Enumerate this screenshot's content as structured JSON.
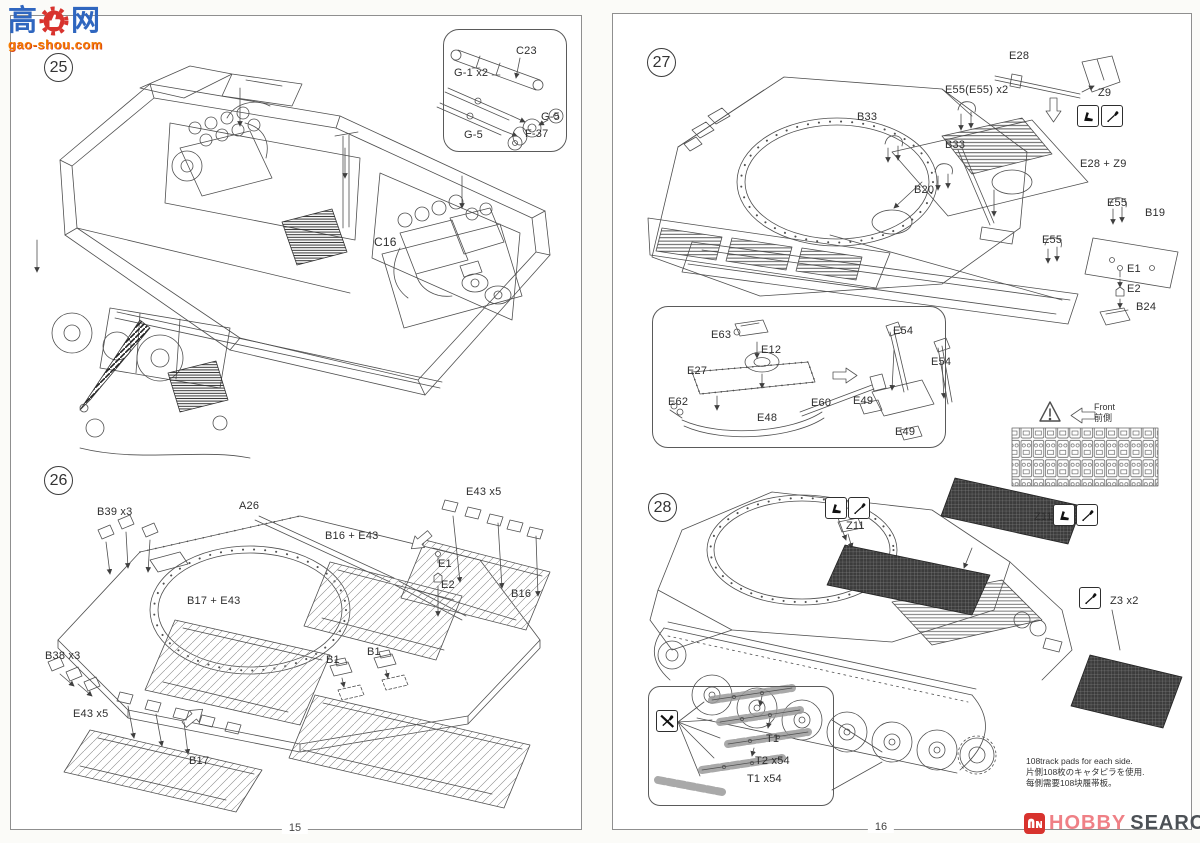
{
  "watermark": {
    "logo": "高达网",
    "url": "gao-shou.com"
  },
  "pages": {
    "left": "15",
    "right": "16"
  },
  "brand": {
    "hobby": "HOBBY",
    "search": "SEARCH"
  },
  "colors": {
    "line": "#4d4d4d",
    "brand_red": "#d8332e",
    "brand_pink": "#ef8086",
    "brand_gray": "#4c5156",
    "watermark_blue": "#2f66bf",
    "watermark_orange": "#f57c00"
  },
  "icons": {
    "bend": "bend-part-icon",
    "glue": "glue-applicator-icon",
    "no_glue": "no-glue-icon",
    "warning": "warning-triangle-icon",
    "front_arrow": "front-direction-arrow-icon",
    "thumb": "thumbs-up-icon",
    "hobby_mark": "hobby-search-mark-icon"
  },
  "steps": {
    "s25": {
      "num": "25",
      "c16": "C16",
      "inset": {
        "c23": "C23",
        "g1": "G-1 x2",
        "g5a": "G-5",
        "g5b": "G-5",
        "f37": "F-37"
      }
    },
    "s26": {
      "num": "26",
      "labels": {
        "b39": "B39 x3",
        "a26": "A26",
        "b16e43": "B16 + E43",
        "b17e43": "B17 + E43",
        "e43_top": "E43 x5",
        "e1": "E1",
        "e2": "E2",
        "b16": "B16",
        "b38": "B38 x3",
        "e43_bottom": "E43 x5",
        "b17": "B17",
        "b1_left": "B1",
        "b1_right": "B1"
      }
    },
    "s27": {
      "num": "27",
      "labels": {
        "e28": "E28",
        "z9": "Z9",
        "e55x2": "E55(E55) x2",
        "b33_left": "B33",
        "b33_right": "B33",
        "b20": "B20",
        "e28z9": "E28 + Z9",
        "e55_right": "E55",
        "b19": "B19",
        "e55_mid": "E55",
        "e1": "E1",
        "e2": "E2",
        "b24": "B24"
      },
      "inset": {
        "e63": "E63",
        "e12": "E12",
        "e27": "E27",
        "e62": "E62",
        "e48": "E48",
        "e60": "E60",
        "e54_top": "E54",
        "e54_right": "E54",
        "e49_left": "E49",
        "e49_bottom": "E49"
      },
      "front": {
        "en": "Front",
        "jp": "前側"
      }
    },
    "s28": {
      "num": "28",
      "labels": {
        "z11_mid": "Z11",
        "z11_right": "Z11",
        "z3": "Z3 x2",
        "t1": "T1",
        "t2x54": "T2 x54",
        "t1x54": "T1 x54"
      },
      "note": [
        "108track pads for each side.",
        "片側108枚のキャタピラを使用.",
        "每側需要108块履帯板。"
      ]
    }
  }
}
